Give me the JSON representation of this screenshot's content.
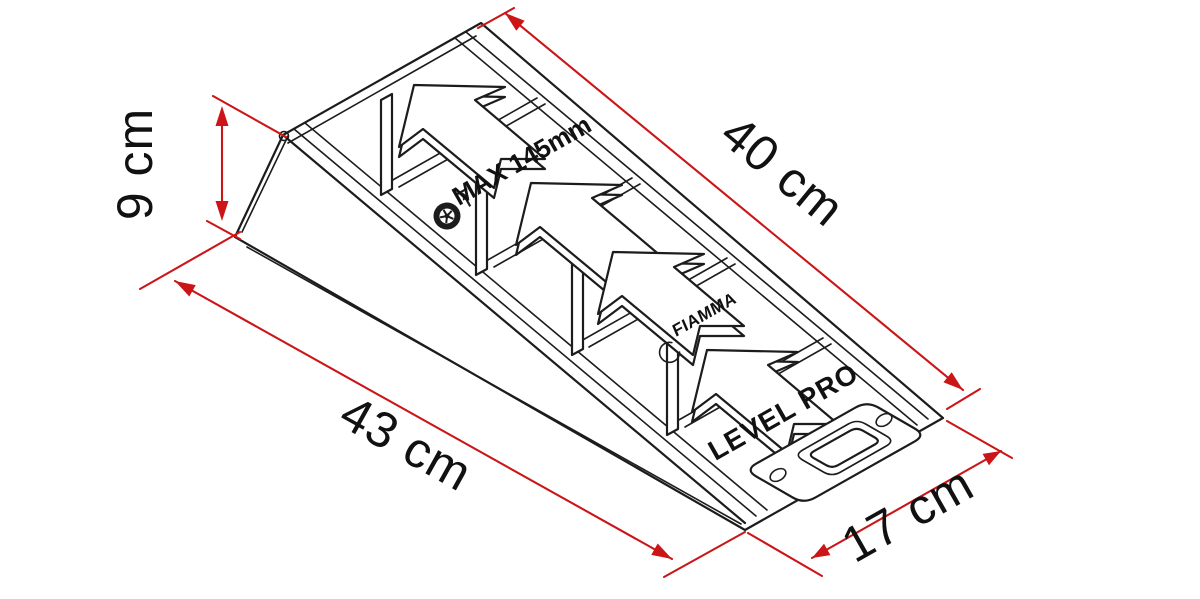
{
  "diagram": {
    "title": "Leveling ramp dimension diagram",
    "product": {
      "brand": "FIAMMA",
      "name_label": "LEVEL PRO",
      "max_label": "MAX 145mm"
    },
    "dimensions": {
      "slope": {
        "label": "40 cm"
      },
      "height": {
        "label": "9 cm"
      },
      "base": {
        "label": "43 cm"
      },
      "width": {
        "label": "17 cm"
      }
    },
    "colors": {
      "dimension_red": "#cc1517",
      "line_black": "#1c1c1c",
      "background": "#ffffff"
    },
    "icons": [
      {
        "name": "wheel-max-height-icon",
        "meaning": "maximum wheel lift height"
      }
    ]
  }
}
